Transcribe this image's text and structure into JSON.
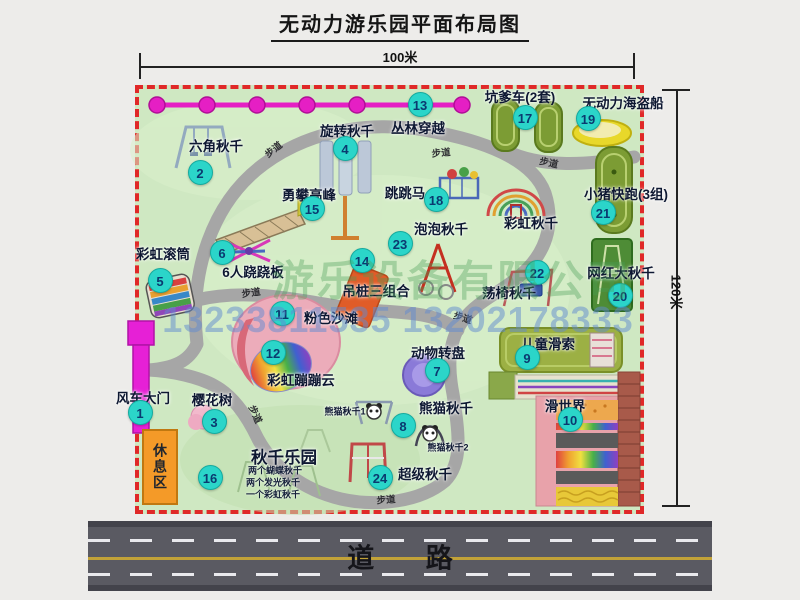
{
  "title": "无动力游乐园平面布局图",
  "dimensions": {
    "width": "100米",
    "height": "120米"
  },
  "road_label": "道 路",
  "watermark": {
    "company": "游乐设备有限公司",
    "phone": "13233811535 13202178333"
  },
  "rest_area_label": "休息区",
  "walkway_label": "步道",
  "extra": {
    "rainbow_swing": "彩虹秋千",
    "panda_swing_1": "熊猫秋千1",
    "panda_swing_2": "熊猫秋千2",
    "swing_park_line1": "两个蝴蝶秋千",
    "swing_park_line2": "两个发光秋千",
    "swing_park_line3": "一个彩虹秋千"
  },
  "attractions": [
    {
      "num": "1",
      "label": "风车大门"
    },
    {
      "num": "2",
      "label": "六角秋千"
    },
    {
      "num": "3",
      "label": "樱花树"
    },
    {
      "num": "4",
      "label": "旋转秋千"
    },
    {
      "num": "5",
      "label": "彩虹滚筒"
    },
    {
      "num": "6",
      "label": "6人跷跷板"
    },
    {
      "num": "7",
      "label": "动物转盘"
    },
    {
      "num": "8",
      "label": "熊猫秋千"
    },
    {
      "num": "9",
      "label": "儿童滑索"
    },
    {
      "num": "10",
      "label": "滑世界"
    },
    {
      "num": "11",
      "label": "粉色沙滩"
    },
    {
      "num": "12",
      "label": "彩虹蹦蹦云"
    },
    {
      "num": "13",
      "label": "丛林穿越"
    },
    {
      "num": "14",
      "label": "吊桩三组合"
    },
    {
      "num": "15",
      "label": "勇攀高峰"
    },
    {
      "num": "16",
      "label": "秋千乐园"
    },
    {
      "num": "17",
      "label": "坑爹车(2套)"
    },
    {
      "num": "18",
      "label": "跳跳马"
    },
    {
      "num": "19",
      "label": "无动力海盗船"
    },
    {
      "num": "20",
      "label": "网红大秋千"
    },
    {
      "num": "21",
      "label": "小猪快跑(3组)"
    },
    {
      "num": "22",
      "label": "荡椅秋千"
    },
    {
      "num": "23",
      "label": "泡泡秋千"
    },
    {
      "num": "24",
      "label": "超级秋千"
    }
  ],
  "colors": {
    "marker": "#2bd5c9",
    "map_border": "#e02828",
    "map_bg": "#cfe8c2",
    "zipline": "#e51fc4",
    "gate": "#e620d6",
    "rest_area": "#f49a28",
    "path": "#a6a6a6",
    "road": "#5a5a62"
  }
}
